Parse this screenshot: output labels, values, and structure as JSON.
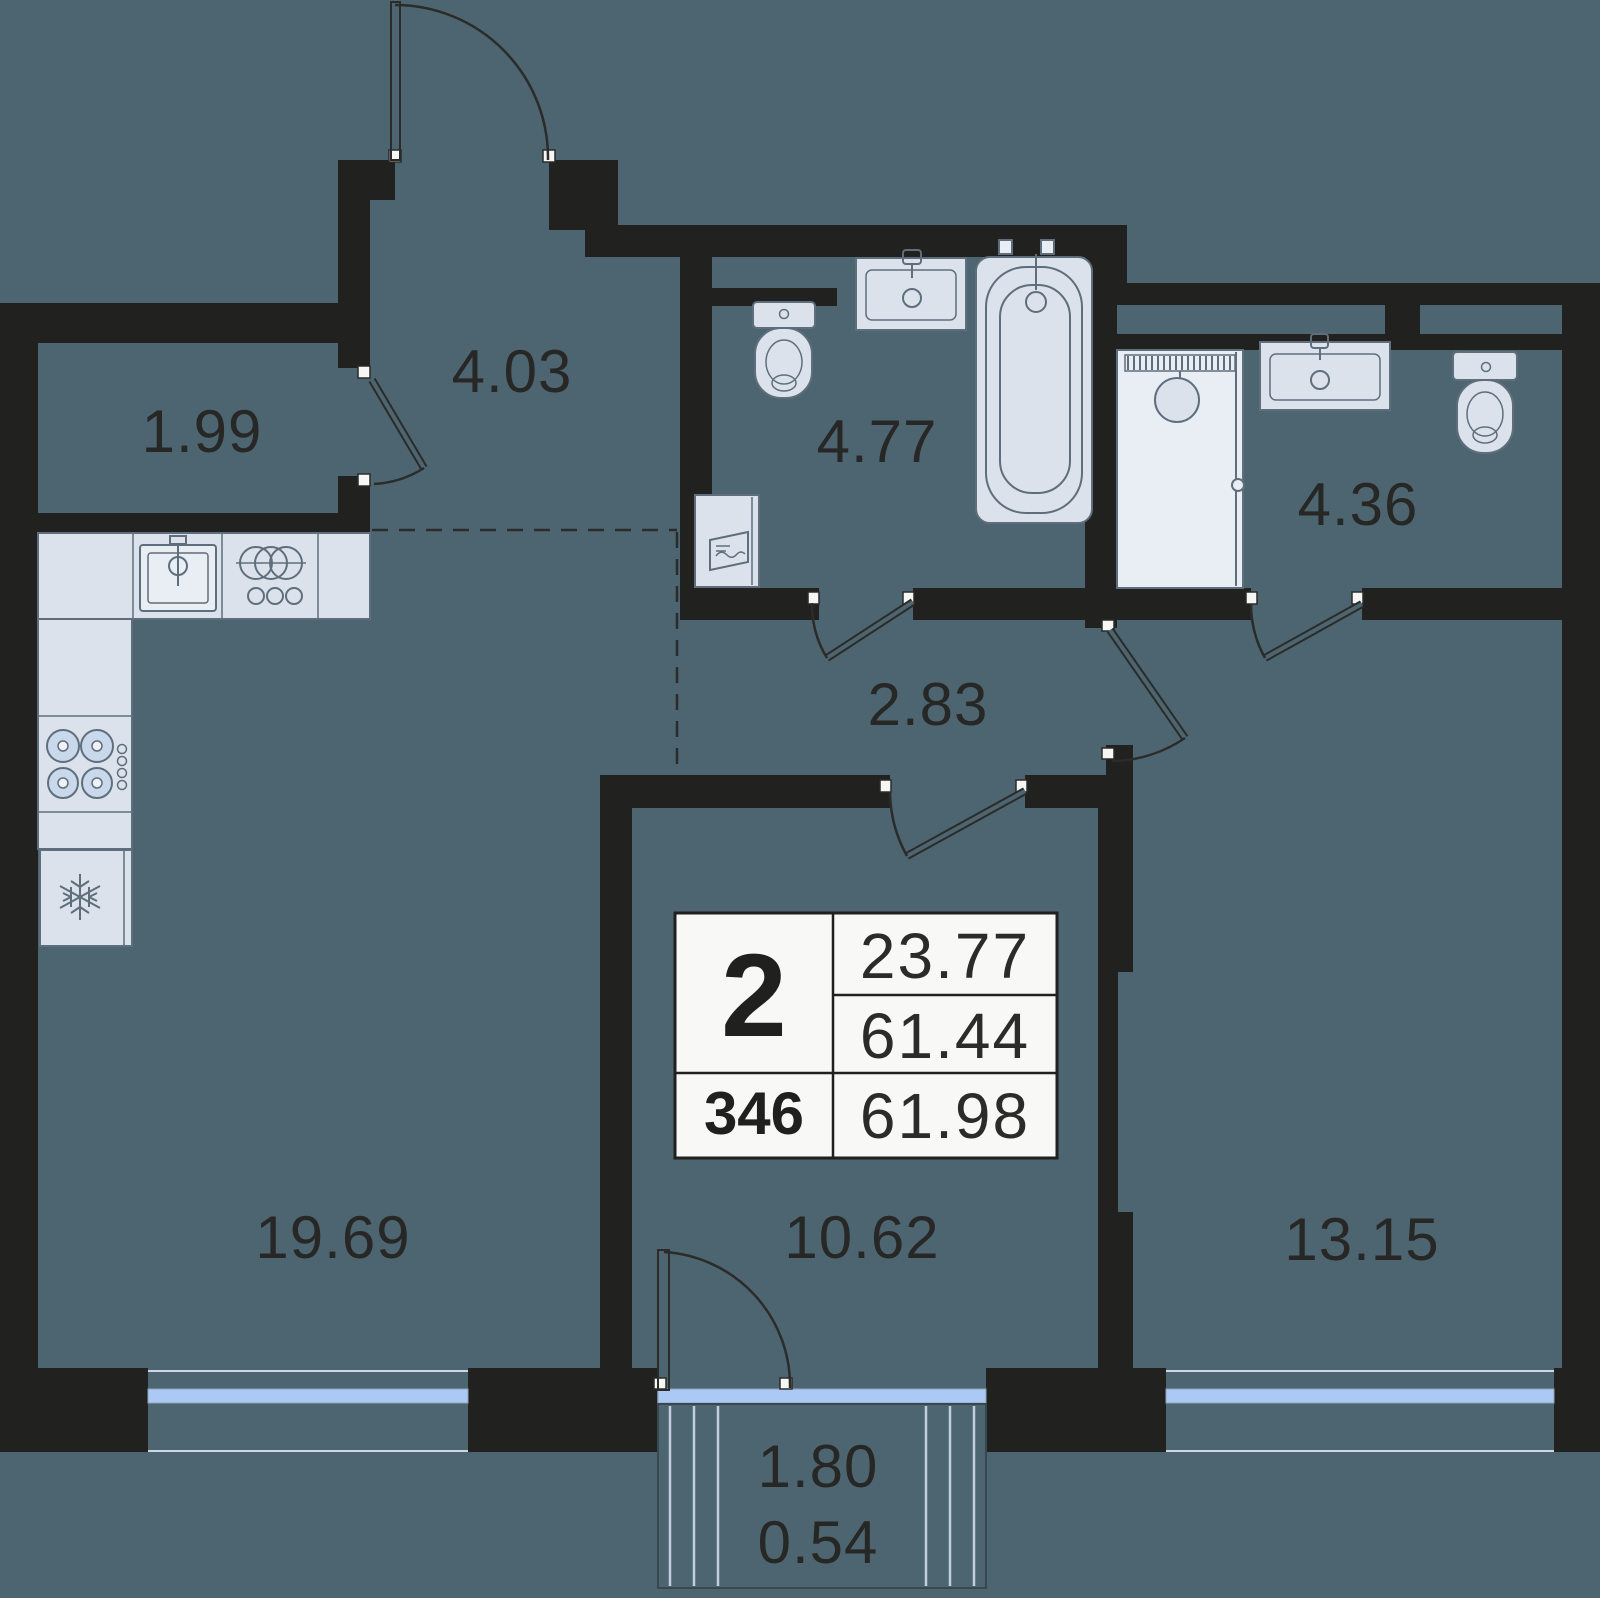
{
  "colors": {
    "background": "#4d6570",
    "wall": "#21211f",
    "window": "#abc9f4",
    "fixture_fill": "#dce2eb",
    "fixture_stroke": "#5f6e7d",
    "card_background": "#f8f8f6",
    "label_text": "#272725"
  },
  "rooms": {
    "closet": {
      "area": "1.99"
    },
    "hallway": {
      "area": "4.03"
    },
    "bathroom": {
      "area": "4.77"
    },
    "bathroom_2": {
      "area": "4.36"
    },
    "corridor": {
      "area": "2.83"
    },
    "kitchen_living": {
      "area": "19.69"
    },
    "bedroom": {
      "area": "10.62"
    },
    "room_2": {
      "area": "13.15"
    }
  },
  "balcony": {
    "area": "1.80",
    "reduced_area": "0.54"
  },
  "info_card": {
    "rooms_count": "2",
    "unit_number": "346",
    "living_area": "23.77",
    "area_without_balcony": "61.44",
    "total_area": "61.98"
  }
}
